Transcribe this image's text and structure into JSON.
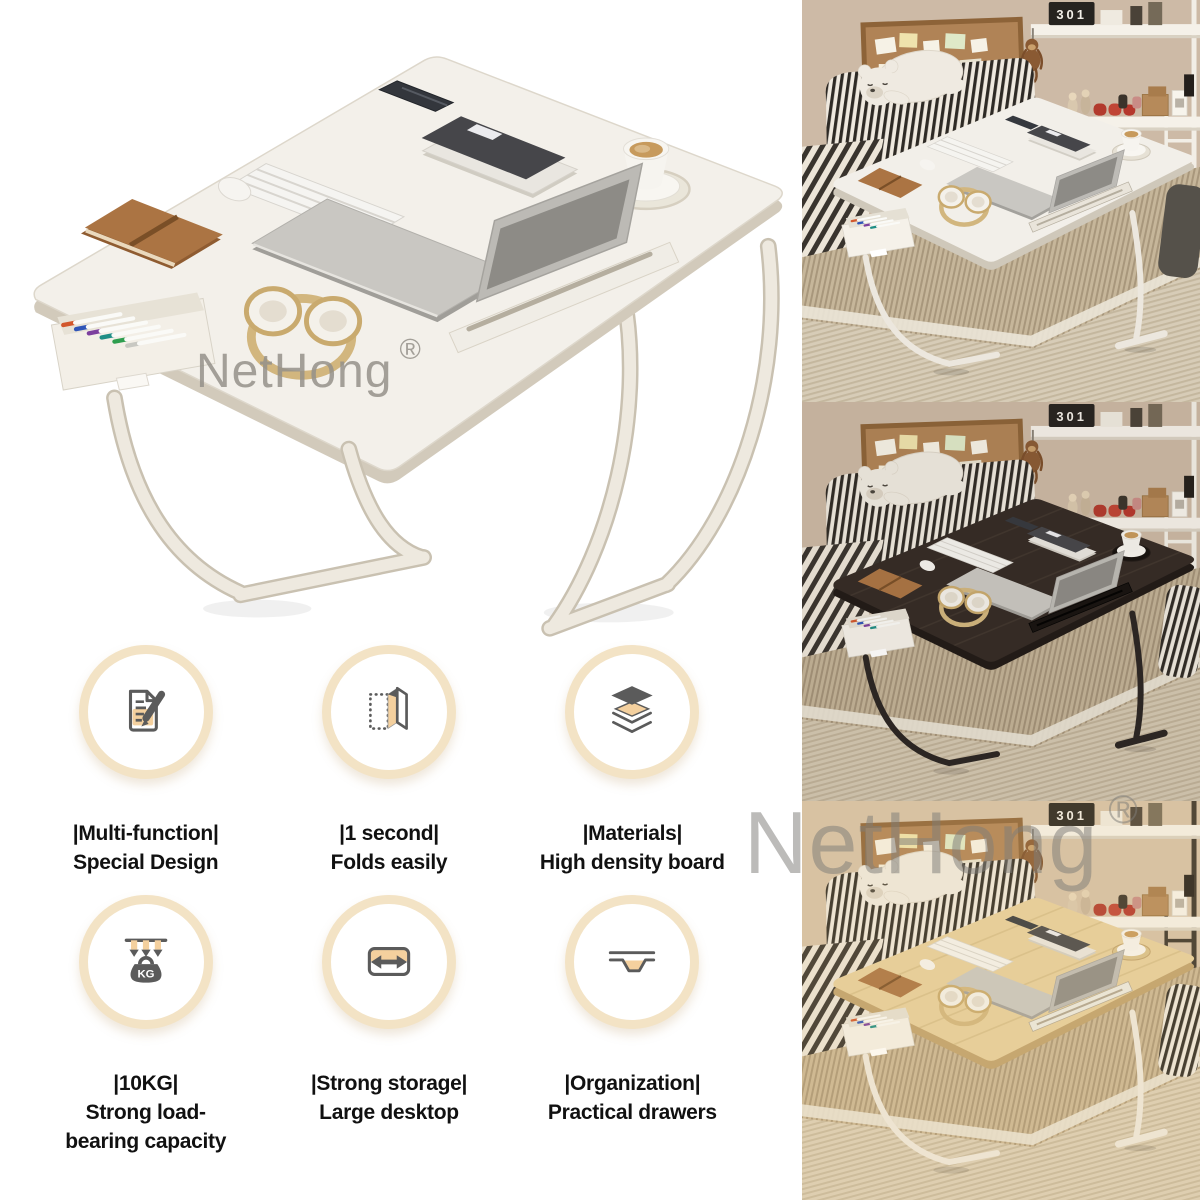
{
  "watermarks": {
    "main_text": "NetHong",
    "main_reg": "®",
    "photo_text": "NetHong",
    "photo_reg": "®"
  },
  "features": [
    {
      "icon": "document-edit-icon",
      "label": "|Multi-function|",
      "desc": "Special Design"
    },
    {
      "icon": "fold-panel-icon",
      "label": "|1 second|",
      "desc": "Folds easily"
    },
    {
      "icon": "layers-icon",
      "label": "|Materials|",
      "desc": "High density board"
    },
    {
      "icon": "weight-kg-icon",
      "label": "|10KG|",
      "desc": "Strong load-\nbearing capacity",
      "icon_text": "KG"
    },
    {
      "icon": "width-arrow-icon",
      "label": "|Strong storage|",
      "desc": "Large desktop"
    },
    {
      "icon": "drawer-tray-icon",
      "label": "|Organization|",
      "desc": "Practical drawers"
    }
  ],
  "feature_style": {
    "ring_color": "#f3e3c5",
    "icon_dark": "#5b5b5b",
    "icon_accent": "#f4d09e",
    "text_color": "#111111"
  },
  "main_photo": {
    "table_top": "#f3f0ea",
    "table_edge": "#d2cabb",
    "legs": "#eee9df",
    "leg_outline": "#c9c1b1",
    "drawer": "#f3efe7",
    "recess": "#eae6da",
    "groove": "#f0ede6",
    "groove_line": "#b5ae9f"
  },
  "pen_cap_colors": [
    "#d2572c",
    "#2f55b8",
    "#7c3f9e",
    "#1f8e86",
    "#2e9e4f",
    "#c8c8c2"
  ],
  "photos_common": {
    "calendar_digits": "301"
  },
  "photos": [
    {
      "variant": "white-desk",
      "wall": "#cdbaa6",
      "table_top": "#f2efe9",
      "table_edge": "#cfc8ba",
      "legs": "#ece7de",
      "grain": "",
      "mat": "#c6b69a",
      "mat_line": "#a8977c",
      "floor": "#d7ccb7",
      "floor_line": "#c4b79e",
      "right_pillow": "plain",
      "pillow_color": "#55514a",
      "recess": "#e6e1d5",
      "groove": "#e9e4da",
      "groove_line": "#b5ae9f",
      "rail": "#f2eee6",
      "tint": "rgba(0,0,0,0)"
    },
    {
      "variant": "black-desk",
      "wall": "#cbb8a4",
      "table_top": "#332a25",
      "table_edge": "#1f1916",
      "legs": "#2a2522",
      "grain": "#4a3f36",
      "mat": "#c2b296",
      "mat_line": "#a39279",
      "floor": "#d3c7b1",
      "floor_line": "#c0b299",
      "right_pillow": "striped",
      "pillow_color": "#3a352e",
      "recess": "#15100d",
      "groove": "#16120f",
      "groove_line": "#000000",
      "rail": "#f2eee6",
      "tint": "rgba(90,70,55,0.06)"
    },
    {
      "variant": "light-wood-desk",
      "wall": "#d6c2a8",
      "table_top": "#e7d09e",
      "table_edge": "#c0a26e",
      "legs": "#efe9df",
      "grain": "#cdb27e",
      "mat": "#cbb795",
      "mat_line": "#ac9878",
      "floor": "#ddd0b8",
      "floor_line": "#c9bba0",
      "right_pillow": "striped",
      "pillow_color": "#3f3a32",
      "recess": "#d9c28c",
      "groove": "#eceae2",
      "groove_line": "#b0a693",
      "rail": "#3a342c",
      "tint": "rgba(236,196,130,0.14)"
    }
  ]
}
